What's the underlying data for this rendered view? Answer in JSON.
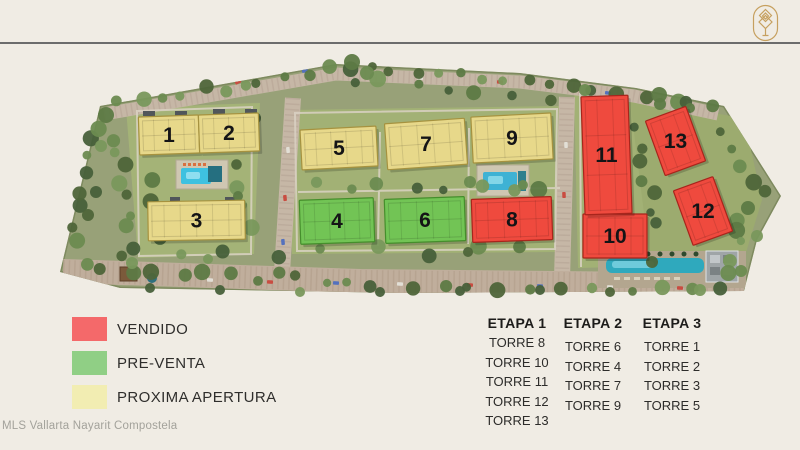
{
  "header": {
    "logo_icon": "tree-diamond-emblem"
  },
  "watermark": "MLS Vallarta Nayarit Compostela",
  "legend": {
    "items": [
      {
        "label": "VENDIDO",
        "status": "vendido",
        "color": "#f4696a"
      },
      {
        "label": "PRE-VENTA",
        "status": "pre-venta",
        "color": "#90cf85"
      },
      {
        "label": "PROXIMA APERTURA",
        "status": "proxima-apertura",
        "color": "#f2edb2"
      }
    ]
  },
  "etapas": [
    {
      "title": "ETAPA 1",
      "towers": [
        "TORRE 8",
        "TORRE 10",
        "TORRE 11",
        "TORRE 12",
        "TORRE 13"
      ]
    },
    {
      "title": "ETAPA 2",
      "towers": [
        "TORRE 6",
        "TORRE 4",
        "TORRE 7",
        "TORRE 9"
      ]
    },
    {
      "title": "ETAPA 3",
      "towers": [
        "TORRE 1",
        "TORRE 2",
        "TORRE 3",
        "TORRE 5"
      ]
    }
  ],
  "site_plan": {
    "towers": [
      {
        "number": "1",
        "status": "proxima-apertura"
      },
      {
        "number": "2",
        "status": "proxima-apertura"
      },
      {
        "number": "3",
        "status": "proxima-apertura"
      },
      {
        "number": "4",
        "status": "pre-venta"
      },
      {
        "number": "5",
        "status": "proxima-apertura"
      },
      {
        "number": "6",
        "status": "pre-venta"
      },
      {
        "number": "7",
        "status": "proxima-apertura"
      },
      {
        "number": "8",
        "status": "vendido"
      },
      {
        "number": "9",
        "status": "proxima-apertura"
      },
      {
        "number": "10",
        "status": "vendido"
      },
      {
        "number": "11",
        "status": "vendido"
      },
      {
        "number": "12",
        "status": "vendido"
      },
      {
        "number": "13",
        "status": "vendido"
      }
    ],
    "status_colors": {
      "vendido": "#ef4a3e",
      "pre-venta": "#72c455",
      "proxima-apertura": "#e7d88a"
    }
  }
}
